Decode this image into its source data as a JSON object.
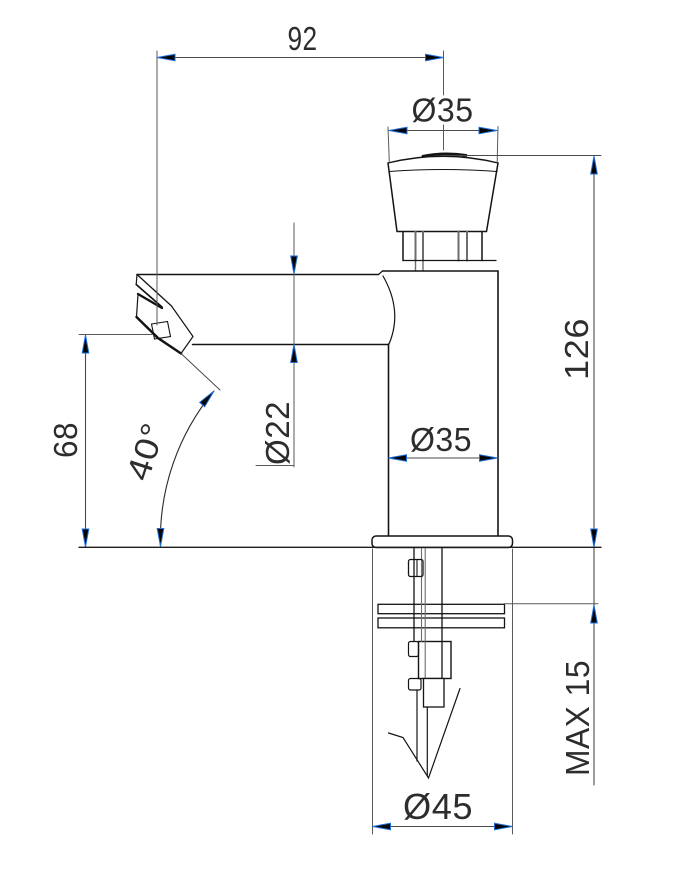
{
  "drawing": {
    "kind": "technical-dimension-drawing",
    "colors": {
      "background": "#ffffff",
      "outline": "#141414",
      "dimension_line": "#555555",
      "arrowhead_fill": "#050505",
      "arrowhead_outline": "#1e6fd9",
      "text": "#2d2d2d"
    },
    "labels": {
      "width": "92",
      "button_diameter": "Ø35",
      "total_height": "126",
      "spout_diameter": "Ø22",
      "spout_height": "68",
      "spout_angle": "40°",
      "body_diameter": "Ø35",
      "max_panel_thickness": "MAX 15",
      "base_diameter": "Ø45"
    }
  }
}
